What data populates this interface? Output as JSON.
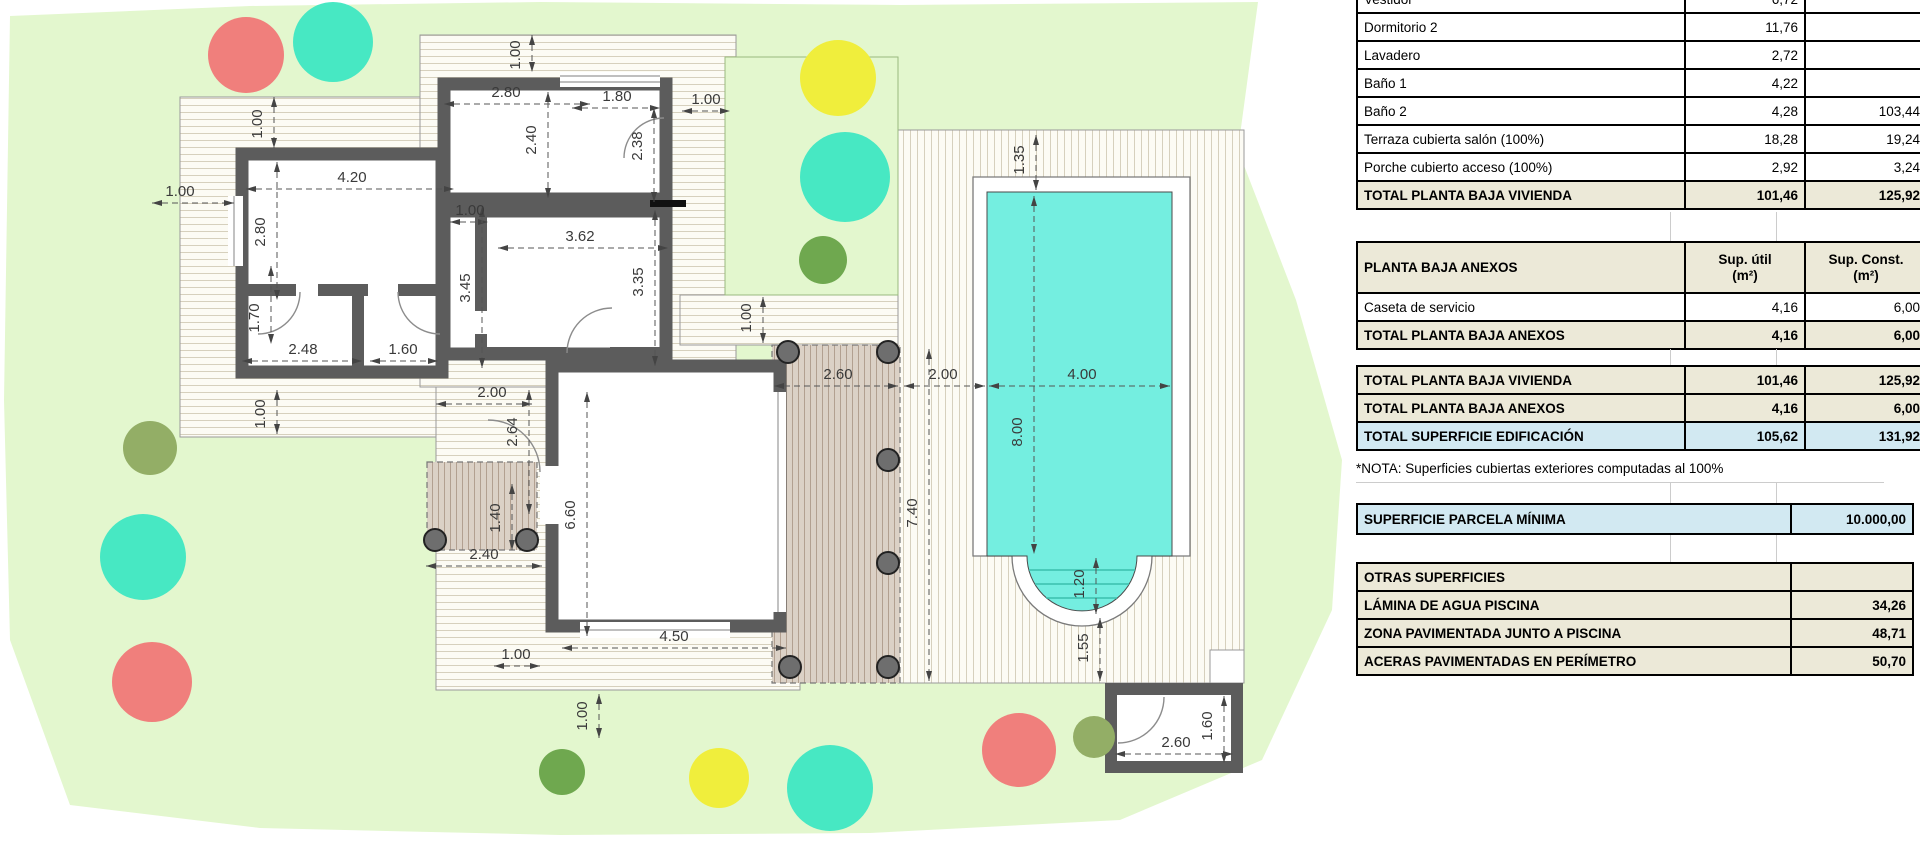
{
  "title": "Plano planta baja con piscina y cuadro de superficies",
  "tables": {
    "planta_baja_vivienda": {
      "rows": [
        {
          "label": "Vestidor",
          "util": "6,72",
          "const": ""
        },
        {
          "label": "Dormitorio 2",
          "util": "11,76",
          "const": ""
        },
        {
          "label": "Lavadero",
          "util": "2,72",
          "const": ""
        },
        {
          "label": "Baño 1",
          "util": "4,22",
          "const": ""
        },
        {
          "label": "Baño 2",
          "util": "4,28",
          "const": "103,44"
        },
        {
          "label": "Terraza cubierta salón (100%)",
          "util": "18,28",
          "const": "19,24"
        },
        {
          "label": "Porche cubierto acceso (100%)",
          "util": "2,92",
          "const": "3,24"
        }
      ],
      "total": {
        "label": "TOTAL PLANTA BAJA VIVIENDA",
        "util": "101,46",
        "const": "125,92"
      }
    },
    "planta_baja_anexos": {
      "header": {
        "label": "PLANTA BAJA ANEXOS",
        "util": "Sup. útil\n(m²)",
        "const": "Sup. Const.\n(m²)"
      },
      "rows": [
        {
          "label": "Caseta de servicio",
          "util": "4,16",
          "const": "6,00"
        }
      ],
      "total": {
        "label": "TOTAL PLANTA BAJA ANEXOS",
        "util": "4,16",
        "const": "6,00"
      }
    },
    "resumen": {
      "rows": [
        {
          "label": "TOTAL PLANTA BAJA VIVIENDA",
          "util": "101,46",
          "const": "125,92"
        },
        {
          "label": "TOTAL PLANTA BAJA ANEXOS",
          "util": "4,16",
          "const": "6,00"
        },
        {
          "label": "TOTAL SUPERFICIE EDIFICACIÓN",
          "util": "105,62",
          "const": "131,92"
        }
      ]
    },
    "nota": "*NOTA: Superficies cubiertas exteriores computadas al 100%",
    "parcela": {
      "label": "SUPERFICIE PARCELA MÍNIMA",
      "value": "10.000,00"
    },
    "otras": {
      "header": "OTRAS SUPERFICIES",
      "rows": [
        {
          "label": "LÁMINA DE AGUA PISCINA",
          "value": "34,26"
        },
        {
          "label": "ZONA PAVIMENTADA JUNTO A PISCINA",
          "value": "48,71"
        },
        {
          "label": "ACERAS PAVIMENTADAS EN PERÍMETRO",
          "value": "50,70"
        }
      ]
    }
  },
  "plan": {
    "colors": {
      "parcel": "#e3f7ce",
      "wall": "#5c5c5c",
      "pool": "#74eee0",
      "pool_step": "#3bbfae",
      "tree_red": "#f07f7c",
      "tree_teal": "#47e8c3",
      "tree_yellow": "#f0ee3c",
      "tree_olive": "#93ae66",
      "tree_green": "#6fa84f",
      "post": "#6e6e6e"
    },
    "dims": [
      "1.00",
      "1.00",
      "2.80",
      "1.80",
      "1.00",
      "2.40",
      "2.38",
      "4.20",
      "2.80",
      "1.00",
      "1.00",
      "3.62",
      "3.45",
      "3.35",
      "1.70",
      "2.48",
      "1.60",
      "1.00",
      "2.00",
      "2.64",
      "1.40",
      "2.40",
      "6.60",
      "4.50",
      "1.00",
      "1.00",
      "1.00",
      "2.60",
      "2.00",
      "4.00",
      "1.35",
      "8.00",
      "7.40",
      "1.20",
      "1.55",
      "2.60",
      "1.60"
    ]
  }
}
